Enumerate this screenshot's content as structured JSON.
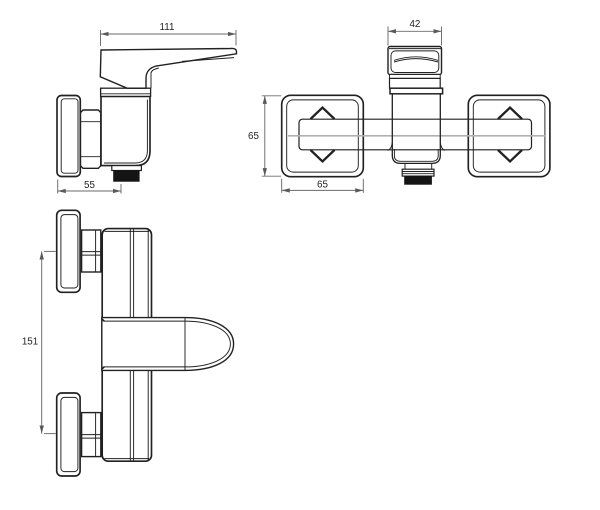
{
  "drawing": {
    "subject": "wall-mounted single-lever shower mixer tap, three dimensioned orthographic views",
    "views": [
      "side view",
      "front view",
      "top view"
    ]
  },
  "colors": {
    "background": "#ffffff",
    "line": "#212121",
    "dimension": "#6a6a6a",
    "outlet_fill": "#141414",
    "center_line": "#b0b0b0"
  },
  "dims": {
    "side_width": "111",
    "side_depth": "55",
    "handle_width": "42",
    "plate_height": "65",
    "plate_width": "65",
    "port_spacing": "151"
  }
}
